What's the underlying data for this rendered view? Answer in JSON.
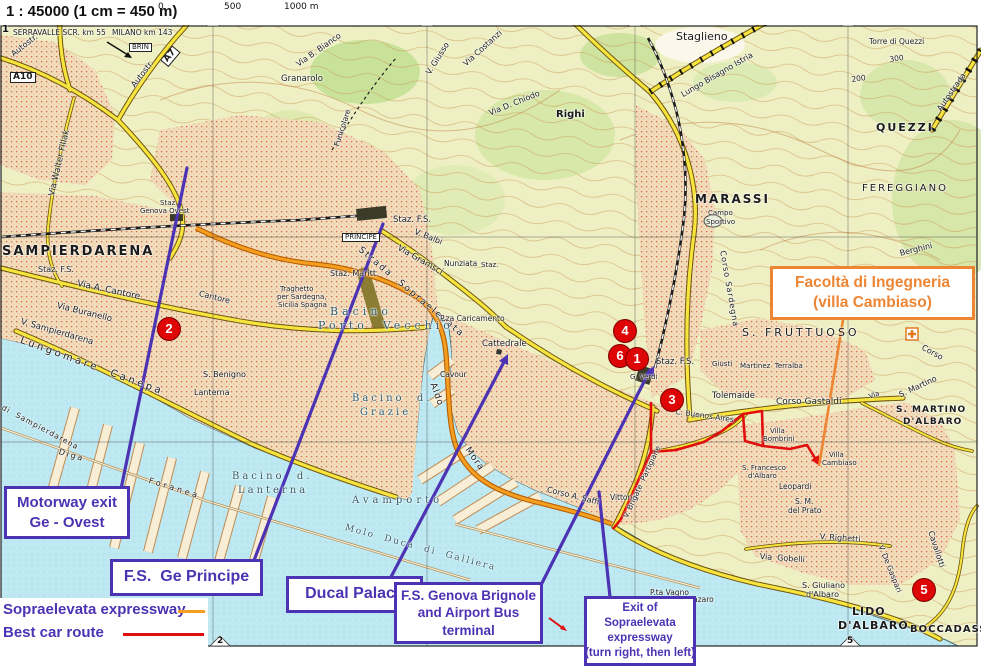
{
  "title": "Genoa city map with driving directions",
  "colors": {
    "water": "#bfe9f2",
    "land": "#eef0c4",
    "urban_dot": "#cf4a38",
    "road_yellow": "#f7e53d",
    "sopraelevata": "#f59f22",
    "route_red": "#e10e0e",
    "callout_purple": "#4c33b3",
    "callout_orange": "#ee8533",
    "marker_red": "#dd0505"
  },
  "header": {
    "scale_text": "1 : 45000 (1 cm = 450 m)",
    "scale_bar": {
      "labels": [
        "0",
        "500",
        "1000 m"
      ]
    }
  },
  "legend": {
    "items": [
      {
        "label": "Sopraelevata expressway",
        "color": "#f59f22",
        "sw": 27
      },
      {
        "label": "Best car route",
        "color": "#e10e0e",
        "sw": 81
      }
    ]
  },
  "grid": {
    "top": [
      {
        "n": "1",
        "x": 6
      },
      {
        "n": "2",
        "x": 213
      },
      {
        "n": "3",
        "x": 427
      },
      {
        "n": "4",
        "x": 635
      },
      {
        "n": "5",
        "x": 848
      }
    ],
    "bottom": [
      {
        "n": "2",
        "x": 220
      },
      {
        "n": "5",
        "x": 850
      }
    ]
  },
  "callouts": [
    {
      "id": "motorway-exit",
      "lines": [
        "Motorway exit",
        "Ge - Ovest"
      ],
      "x": 4,
      "y": 486,
      "w": 126,
      "h": 53,
      "fs": 15,
      "accent": "purple"
    },
    {
      "id": "fs-ge-principe",
      "lines": [
        "F.S.  Ge Principe"
      ],
      "x": 110,
      "y": 559,
      "w": 153,
      "h": 37,
      "fs": 16,
      "accent": "purple"
    },
    {
      "id": "ducal-palace",
      "lines": [
        "Ducal Palace"
      ],
      "x": 286,
      "y": 576,
      "w": 137,
      "h": 37,
      "fs": 16,
      "accent": "purple"
    },
    {
      "id": "fs-genova-brignole",
      "lines": [
        "F.S. Genova Brignole",
        "and Airport Bus",
        "terminal"
      ],
      "x": 394,
      "y": 582,
      "w": 149,
      "h": 62,
      "fs": 13.5,
      "accent": "purple"
    },
    {
      "id": "sopraelevata-exit",
      "lines": [
        "Exit of",
        "Sopraelevata",
        "expressway",
        "(turn right, then left)"
      ],
      "x": 584,
      "y": 596,
      "w": 112,
      "h": 70,
      "fs": 11.5,
      "accent": "purple"
    },
    {
      "id": "facolta-ingegneria",
      "lines": [
        "Facoltà di Ingegneria",
        "(villa Cambiaso)"
      ],
      "x": 770,
      "y": 266,
      "w": 205,
      "h": 54,
      "fs": 15.5,
      "accent": "orange"
    }
  ],
  "map": {
    "route_markers": [
      {
        "n": "2",
        "x": 169,
        "y": 329
      },
      {
        "n": "4",
        "x": 625,
        "y": 331
      },
      {
        "n": "6",
        "x": 620,
        "y": 356
      },
      {
        "n": "1",
        "x": 637,
        "y": 359
      },
      {
        "n": "3",
        "x": 672,
        "y": 400
      },
      {
        "n": "5",
        "x": 924,
        "y": 590
      }
    ],
    "labels": [
      {
        "t": "SERRAVALLE SCR. km 55",
        "x": 13,
        "y": 29,
        "fs": 7.5
      },
      {
        "t": "MILANO km 143",
        "x": 112,
        "y": 29,
        "fs": 7.5
      },
      {
        "t": "BRIN",
        "x": 129,
        "y": 43,
        "fs": 7,
        "box": 1
      },
      {
        "t": "Autostr.",
        "x": 10,
        "y": 52,
        "fs": 8,
        "rot": -38
      },
      {
        "t": "A10",
        "x": 10,
        "y": 72,
        "fs": 9,
        "b": 1,
        "box": 1
      },
      {
        "t": "A7",
        "x": 160,
        "y": 60,
        "fs": 9,
        "b": 1,
        "box": 1,
        "rot": -50
      },
      {
        "t": "Autostr.",
        "x": 130,
        "y": 84,
        "fs": 8,
        "rot": -52
      },
      {
        "t": "Via Walter Fillak",
        "x": 48,
        "y": 195,
        "fs": 8.5,
        "rot": -77
      },
      {
        "t": "Granarolo",
        "x": 281,
        "y": 75,
        "fs": 8.5
      },
      {
        "t": "Via B. Bianco",
        "x": 295,
        "y": 62,
        "fs": 8,
        "rot": -35
      },
      {
        "t": "Funicolare",
        "x": 333,
        "y": 145,
        "fs": 7.5,
        "rot": -72
      },
      {
        "t": "V. Giusso",
        "x": 425,
        "y": 72,
        "fs": 8,
        "rot": -58
      },
      {
        "t": "Via Costanzi",
        "x": 462,
        "y": 62,
        "fs": 8,
        "rot": -42
      },
      {
        "t": "Via D. Chiodo",
        "x": 488,
        "y": 110,
        "fs": 8,
        "rot": -22
      },
      {
        "t": "Righi",
        "x": 556,
        "y": 110,
        "fs": 10,
        "b": 1
      },
      {
        "t": "AUTOSTRADA",
        "x": 601,
        "y": 6,
        "fs": 9,
        "ls": 1.5
      },
      {
        "t": "Staglieno",
        "x": 676,
        "y": 31,
        "fs": 11
      },
      {
        "t": "Lungo Bisagno Istria",
        "x": 680,
        "y": 92,
        "fs": 8,
        "rot": -30
      },
      {
        "t": "Autostrada",
        "x": 936,
        "y": 108,
        "fs": 8,
        "rot": -55
      },
      {
        "t": "Torre di Quezzi",
        "x": 869,
        "y": 38,
        "fs": 7.5
      },
      {
        "t": "300",
        "x": 889,
        "y": 56,
        "fs": 7.5,
        "rot": -8
      },
      {
        "t": "200",
        "x": 851,
        "y": 76,
        "fs": 7.5,
        "rot": -8
      },
      {
        "t": "QUEZZI",
        "x": 876,
        "y": 122,
        "fs": 11,
        "b": 1,
        "ls": 2
      },
      {
        "t": "FEREGGIANO",
        "x": 862,
        "y": 184,
        "fs": 10,
        "ls": 2
      },
      {
        "t": "Berghini",
        "x": 899,
        "y": 250,
        "fs": 8,
        "rot": -14
      },
      {
        "t": "MARASSI",
        "x": 695,
        "y": 193,
        "fs": 12,
        "b": 1,
        "ls": 2
      },
      {
        "t": "Campo",
        "x": 708,
        "y": 210,
        "fs": 7
      },
      {
        "t": "Sportivo",
        "x": 706,
        "y": 219,
        "fs": 7
      },
      {
        "t": "SAMPIERDARENA",
        "x": 2,
        "y": 245,
        "fs": 13,
        "b": 1,
        "ls": 2
      },
      {
        "t": "Staz. F.S.",
        "x": 38,
        "y": 266,
        "fs": 8
      },
      {
        "t": "Via A. Cantore",
        "x": 78,
        "y": 280,
        "fs": 9,
        "rot": 12
      },
      {
        "t": "Via Buranello",
        "x": 58,
        "y": 302,
        "fs": 8.5,
        "rot": 14
      },
      {
        "t": "V. Sampierdarena",
        "x": 22,
        "y": 318,
        "fs": 8.5,
        "rot": 16
      },
      {
        "t": "Lungomare  Canepa",
        "x": 22,
        "y": 336,
        "fs": 10,
        "rot": 20,
        "ls": 3
      },
      {
        "t": "Staz.",
        "x": 160,
        "y": 200,
        "fs": 7
      },
      {
        "t": "Genova Ovest",
        "x": 140,
        "y": 208,
        "fs": 7
      },
      {
        "t": "Cantore",
        "x": 200,
        "y": 290,
        "fs": 8,
        "rot": 14
      },
      {
        "t": "Traghetto",
        "x": 280,
        "y": 286,
        "fs": 7
      },
      {
        "t": "per Sardegna,",
        "x": 277,
        "y": 294,
        "fs": 7
      },
      {
        "t": "Sicilia Spagna",
        "x": 278,
        "y": 302,
        "fs": 7
      },
      {
        "t": "S. Benigno",
        "x": 203,
        "y": 371,
        "fs": 8
      },
      {
        "t": "Lanterna",
        "x": 194,
        "y": 389,
        "fs": 8
      },
      {
        "t": "di  Sampierdarena",
        "x": 4,
        "y": 404,
        "fs": 7.5,
        "rot": 28,
        "ls": 1
      },
      {
        "t": "Diga",
        "x": 60,
        "y": 448,
        "fs": 8,
        "rot": 17,
        "ls": 2
      },
      {
        "t": "Foranea",
        "x": 150,
        "y": 477,
        "fs": 8,
        "rot": 17,
        "ls": 3
      },
      {
        "t": "PRINCIPE",
        "x": 342,
        "y": 233,
        "fs": 7,
        "box": 1
      },
      {
        "t": "Staz. F.S.",
        "x": 393,
        "y": 216,
        "fs": 8.5
      },
      {
        "t": "V. Balbi",
        "x": 416,
        "y": 228,
        "fs": 8,
        "rot": 22
      },
      {
        "t": "Via Gramsci",
        "x": 400,
        "y": 244,
        "fs": 8.5,
        "rot": 30
      },
      {
        "t": "Strada  Sopraelevata",
        "x": 362,
        "y": 246,
        "fs": 9,
        "rot": 40,
        "ls": 2
      },
      {
        "t": "Staz. Maritt.",
        "x": 330,
        "y": 270,
        "fs": 8
      },
      {
        "t": "Nunziata",
        "x": 444,
        "y": 260,
        "fs": 7.5
      },
      {
        "t": "Staz.",
        "x": 481,
        "y": 262,
        "fs": 7
      },
      {
        "t": "P.za Caricamento",
        "x": 440,
        "y": 315,
        "fs": 7.5
      },
      {
        "t": "Cattedrale",
        "x": 482,
        "y": 340,
        "fs": 8.5
      },
      {
        "t": "Cavour",
        "x": 440,
        "y": 371,
        "fs": 7.5
      },
      {
        "t": "Aldo",
        "x": 436,
        "y": 382,
        "fs": 9,
        "rot": 70,
        "ls": 1
      },
      {
        "t": "Mora",
        "x": 470,
        "y": 446,
        "fs": 9,
        "rot": 55,
        "ls": 1
      },
      {
        "t": "Bacino",
        "x": 330,
        "y": 306,
        "fs": 11,
        "ls": 4,
        "cls": "water"
      },
      {
        "t": "Porto  Vecchio",
        "x": 318,
        "y": 320,
        "fs": 11,
        "ls": 4,
        "cls": "water"
      },
      {
        "t": "Bacino  d.",
        "x": 352,
        "y": 394,
        "fs": 10,
        "ls": 3,
        "cls": "water"
      },
      {
        "t": "Grazie",
        "x": 360,
        "y": 408,
        "fs": 10,
        "ls": 3,
        "cls": "water"
      },
      {
        "t": "Bacino  d.",
        "x": 232,
        "y": 472,
        "fs": 10,
        "ls": 3,
        "cls": "water"
      },
      {
        "t": "Lanterna",
        "x": 238,
        "y": 486,
        "fs": 10,
        "ls": 3,
        "cls": "water"
      },
      {
        "t": "Avamporto",
        "x": 352,
        "y": 496,
        "fs": 10,
        "ls": 4,
        "cls": "water"
      },
      {
        "t": "Molo  Duca  di  Galliera",
        "x": 346,
        "y": 524,
        "fs": 9,
        "rot": 15,
        "ls": 2,
        "cls": "water"
      },
      {
        "t": "G. Verdi",
        "x": 630,
        "y": 374,
        "fs": 7
      },
      {
        "t": "Staz. F.S.",
        "x": 656,
        "y": 358,
        "fs": 8.5
      },
      {
        "t": "Giusti",
        "x": 712,
        "y": 361,
        "fs": 7
      },
      {
        "t": "Martinez  Terralba",
        "x": 740,
        "y": 363,
        "fs": 7
      },
      {
        "t": "S. FRUTTUOSO",
        "x": 742,
        "y": 327,
        "fs": 11,
        "ls": 3
      },
      {
        "t": "Corso Sardegna",
        "x": 726,
        "y": 250,
        "fs": 8,
        "rot": 80,
        "ls": 1
      },
      {
        "t": "Tolemaide",
        "x": 712,
        "y": 392,
        "fs": 8.5
      },
      {
        "t": "Corso Gastaldi",
        "x": 776,
        "y": 398,
        "fs": 9
      },
      {
        "t": "S. Martino",
        "x": 898,
        "y": 392,
        "fs": 8,
        "rot": -25
      },
      {
        "t": "Via",
        "x": 868,
        "y": 394,
        "fs": 7,
        "rot": -20
      },
      {
        "t": "S. MARTINO",
        "x": 896,
        "y": 406,
        "fs": 9,
        "b": 1,
        "ls": 1
      },
      {
        "t": "D'ALBARO",
        "x": 903,
        "y": 418,
        "fs": 9,
        "b": 1,
        "ls": 1
      },
      {
        "t": "Corso",
        "x": 924,
        "y": 344,
        "fs": 8,
        "rot": 28
      },
      {
        "t": "Villa",
        "x": 770,
        "y": 428,
        "fs": 7
      },
      {
        "t": "Bombrini",
        "x": 763,
        "y": 436,
        "fs": 7
      },
      {
        "t": "Villa",
        "x": 829,
        "y": 452,
        "fs": 7
      },
      {
        "t": "Cambiaso",
        "x": 822,
        "y": 460,
        "fs": 7
      },
      {
        "t": "S. Francesco",
        "x": 742,
        "y": 465,
        "fs": 7
      },
      {
        "t": "d'Albaro",
        "x": 748,
        "y": 473,
        "fs": 7
      },
      {
        "t": "Leopardi",
        "x": 779,
        "y": 483,
        "fs": 7.5
      },
      {
        "t": "S. M.",
        "x": 795,
        "y": 498,
        "fs": 7.5
      },
      {
        "t": "del Prato",
        "x": 788,
        "y": 507,
        "fs": 7.5
      },
      {
        "t": "V. Righetti",
        "x": 820,
        "y": 533,
        "fs": 8,
        "rot": 4
      },
      {
        "t": "Via  Gobelli",
        "x": 760,
        "y": 553,
        "fs": 8,
        "rot": 4
      },
      {
        "t": "V. De Gaspari",
        "x": 884,
        "y": 544,
        "fs": 7.5,
        "rot": 68
      },
      {
        "t": "Cavallotti",
        "x": 934,
        "y": 530,
        "fs": 8,
        "rot": 72
      },
      {
        "t": "S. Giuliano",
        "x": 802,
        "y": 582,
        "fs": 8
      },
      {
        "t": "d'Albaro",
        "x": 806,
        "y": 591,
        "fs": 8
      },
      {
        "t": "LIDO",
        "x": 852,
        "y": 606,
        "fs": 11,
        "b": 1,
        "ls": 1
      },
      {
        "t": "D'ALBARO",
        "x": 838,
        "y": 620,
        "fs": 11,
        "b": 1,
        "ls": 1
      },
      {
        "t": "BOCCADASSE",
        "x": 910,
        "y": 625,
        "fs": 10,
        "b": 1,
        "ls": 1
      },
      {
        "t": "P.ta Vagno",
        "x": 650,
        "y": 589,
        "fs": 7.5
      },
      {
        "t": "S. Nazaro",
        "x": 678,
        "y": 596,
        "fs": 7.5
      },
      {
        "t": "Vittoria",
        "x": 610,
        "y": 494,
        "fs": 7.5
      },
      {
        "t": "V. Brigate  Partigiane",
        "x": 622,
        "y": 516,
        "fs": 7.5,
        "rot": -65
      },
      {
        "t": "C. Buenos Aires",
        "x": 676,
        "y": 408,
        "fs": 7.5,
        "rot": 8
      },
      {
        "t": "Corso A. Saffi",
        "x": 548,
        "y": 486,
        "fs": 8,
        "rot": 14
      }
    ]
  }
}
